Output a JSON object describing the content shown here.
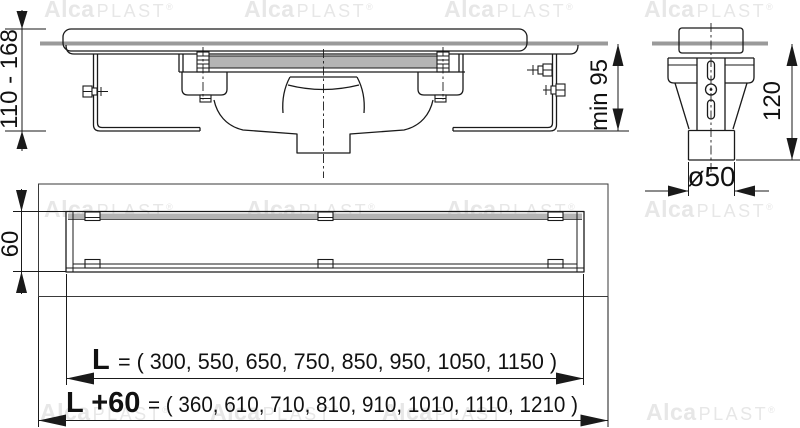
{
  "brand": {
    "bold": "Alca",
    "rest": "PLAST",
    "registered": "®"
  },
  "dimensions": {
    "height_range": "110 - 168",
    "min_depth": "min 95",
    "side_depth": "120",
    "pipe_diameter": "ø50",
    "channel_width": "60"
  },
  "lengths": {
    "l": {
      "label": "L",
      "values": "= ( 300, 550, 650, 750, 850, 950, 1050, 1150 )"
    },
    "l_plus_60": {
      "label": "L +60",
      "values": "= ( 360, 610, 710, 810, 910, 1010, 1110, 1210 )"
    }
  },
  "colors": {
    "line": "#1a1a1a",
    "floor_gray": "#9a9a9a",
    "grate_gray": "#b4b4b4",
    "watermark": "#e7e7e7",
    "background": "#ffffff"
  }
}
